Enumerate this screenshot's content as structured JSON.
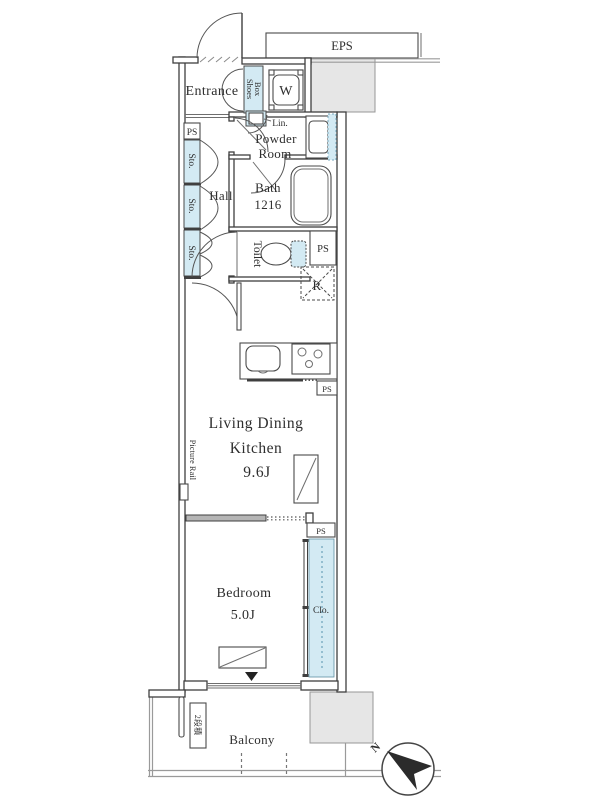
{
  "colors": {
    "wall_line": "#3f3f3f",
    "storage_fill": "#d3eaf3",
    "common_area_fill": "#e6e6e6",
    "boundary_gray": "#9a9a9a",
    "compass_needle": "#2b2b2b"
  },
  "rooms": {
    "entrance": {
      "label": "Entrance"
    },
    "hall": {
      "label": "Hall"
    },
    "powder_room": {
      "name_lines": [
        "Powder",
        "Room"
      ]
    },
    "bath": {
      "label": "Bath",
      "size": "1216"
    },
    "toilet": {
      "label": "Toilet"
    },
    "living_dining_kitchen": {
      "name_lines": [
        "Living Dining",
        "Kitchen"
      ],
      "size": "9.6J"
    },
    "bedroom": {
      "label": "Bedroom",
      "size": "5.0J"
    },
    "balcony": {
      "label": "Balcony"
    }
  },
  "storage": {
    "shoes_box_lines": [
      "Shoes",
      "Box"
    ],
    "storage_abbr": "Sto.",
    "linen_abbr": "Lin.",
    "closet_abbr": "Clo."
  },
  "equipment": {
    "eps": "EPS",
    "pipe_space": "PS",
    "washer": "W",
    "refrigerator": "R"
  },
  "annotations": {
    "picture_rail": "Picture Rail",
    "stacked_tag": "2段積",
    "north": "N"
  }
}
